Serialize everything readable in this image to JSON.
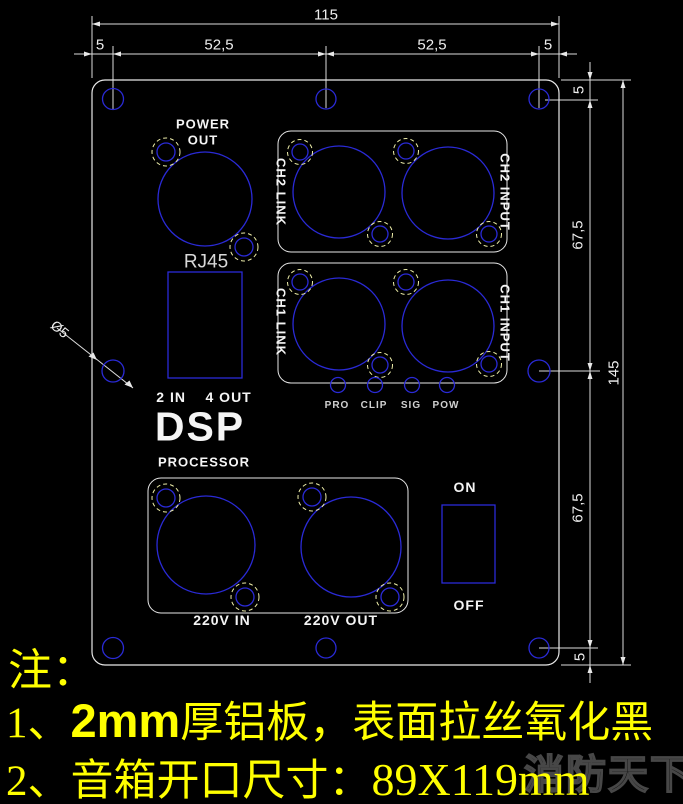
{
  "dims": {
    "top_total": "115",
    "top_left_margin": "5",
    "top_left_span": "52,5",
    "top_right_span": "52,5",
    "top_right_margin": "5",
    "right_top_margin": "5",
    "right_upper_span": "67,5",
    "right_total": "145",
    "right_lower_span": "67,5",
    "right_bottom_margin": "5",
    "hole_diameter": "Ø5"
  },
  "panel": {
    "power_out_line1": "POWER",
    "power_out_line2": "OUT",
    "rj45": "RJ45",
    "io_label": "2 IN    4 OUT",
    "dsp": "DSP",
    "processor": "PROCESSOR",
    "ch2_link": "CH2 LINK",
    "ch2_input": "CH2 INPUT",
    "ch1_link": "CH1 LINK",
    "ch1_input": "CH1 INPUT",
    "leds": [
      "PRO",
      "CLIP",
      "SIG",
      "POW"
    ],
    "v220_in": "220V IN",
    "v220_out": "220V OUT",
    "switch_on": "ON",
    "switch_off": "OFF"
  },
  "notes": {
    "heading": "注：",
    "line1_num": "1、",
    "line1_bold": "2mm",
    "line1_rest": "厚铝板，表面拉丝氧化黑",
    "line2_num": "2、",
    "line2_cn": "音箱开口尺寸：",
    "line2_size": "89X119mm"
  },
  "watermark": "消防天下",
  "colors": {
    "background": "#000000",
    "outline_white": "#e8e8e8",
    "cut_blue": "#2828d8",
    "screw_dash_yellow": "#eeeeaa",
    "note_yellow": "#ffff00"
  }
}
